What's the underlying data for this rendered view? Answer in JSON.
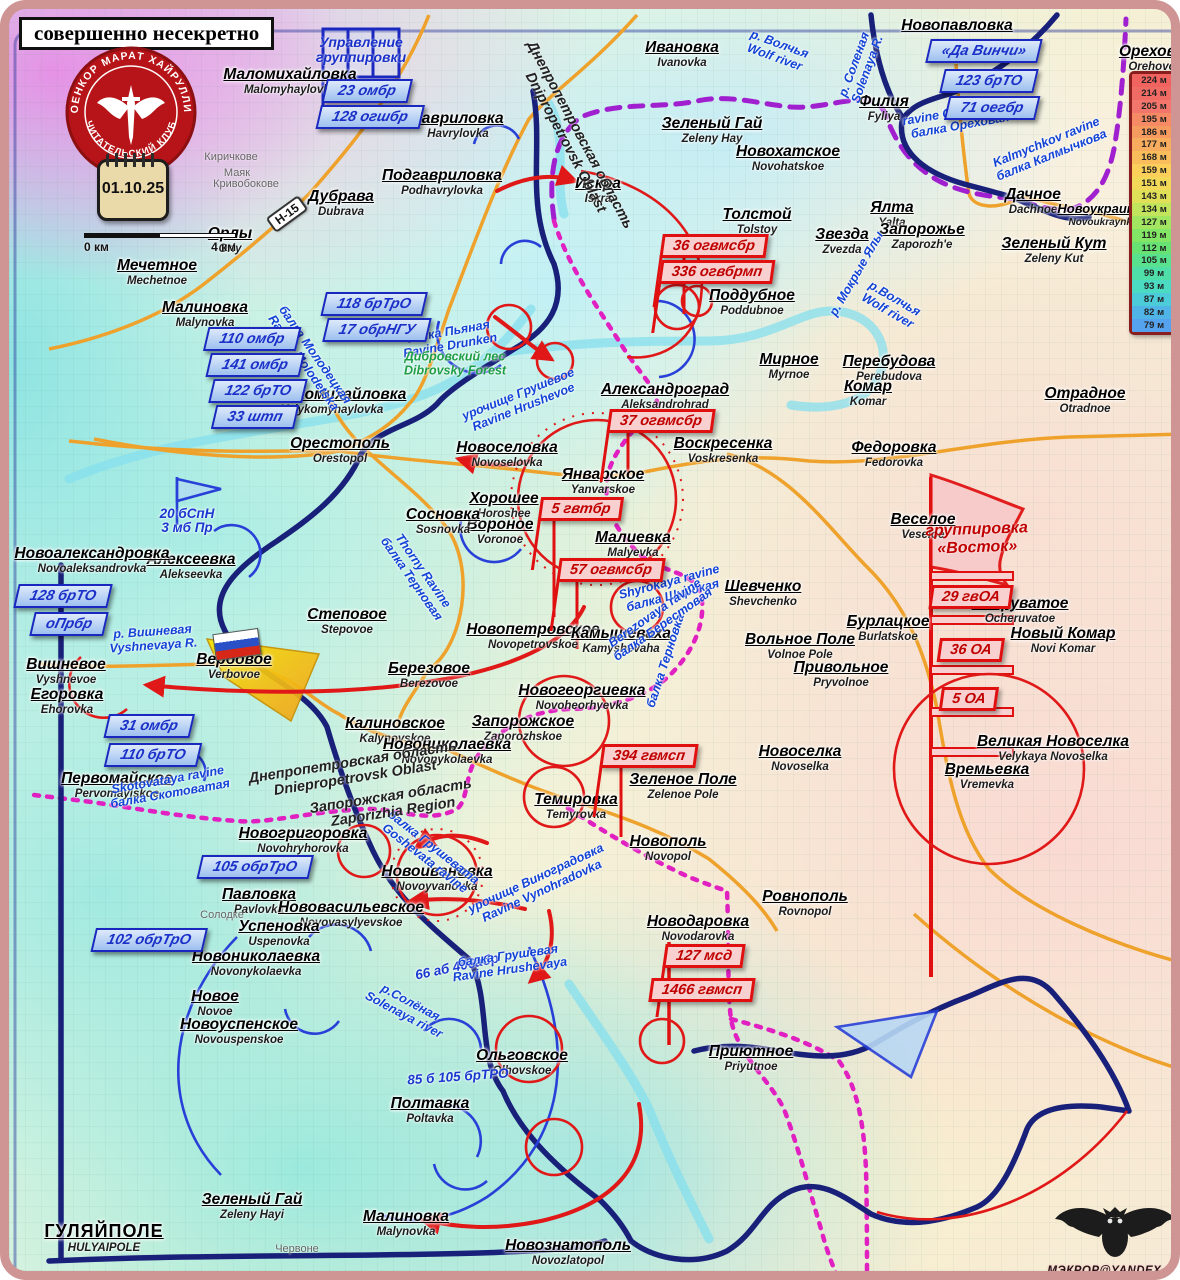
{
  "header": {
    "classification": "совершенно несекретно"
  },
  "logo": {
    "ring_top": "ВОЕНКОР МАРАТ ХАЙРУЛЛИН",
    "ring_bottom": "ЧИТАТЕЛЬСКИЙ КЛУБ"
  },
  "calendar": {
    "date": "01.10.25"
  },
  "scalebar": {
    "start": "0 км",
    "end": "4 км"
  },
  "road_badge": "Н-15",
  "hq_flag": {
    "line1": "Управление",
    "line2": "группировки"
  },
  "grouping_flag": {
    "line1": "группировка",
    "line2": "«Восток»"
  },
  "watermark": {
    "text": "МЭКРОР@YANDEX.RU"
  },
  "legend": {
    "entries": [
      {
        "label": "224 м",
        "color": "#f0635f"
      },
      {
        "label": "214 м",
        "color": "#f06b64"
      },
      {
        "label": "205 м",
        "color": "#f2766b"
      },
      {
        "label": "195 м",
        "color": "#f58a64"
      },
      {
        "label": "186 м",
        "color": "#f69b60"
      },
      {
        "label": "177 м",
        "color": "#f8ac5e"
      },
      {
        "label": "168 м",
        "color": "#f9bd5c"
      },
      {
        "label": "159 м",
        "color": "#fbcf5a"
      },
      {
        "label": "151 м",
        "color": "#f2d957"
      },
      {
        "label": "143 м",
        "color": "#dfdf58"
      },
      {
        "label": "134 м",
        "color": "#c2e35c"
      },
      {
        "label": "127 м",
        "color": "#a2e560"
      },
      {
        "label": "119 м",
        "color": "#82e566"
      },
      {
        "label": "112 м",
        "color": "#68e273"
      },
      {
        "label": "105 м",
        "color": "#59e18d"
      },
      {
        "label": "99 м",
        "color": "#4fdea8"
      },
      {
        "label": "93 м",
        "color": "#4bdac2"
      },
      {
        "label": "87 м",
        "color": "#4cccd8"
      },
      {
        "label": "82 м",
        "color": "#50b5e6"
      },
      {
        "label": "79 м",
        "color": "#55a3ef"
      }
    ]
  },
  "places": [
    {
      "n": "Маломихайловка",
      "t": "Malomyhaylovka",
      "x": 281,
      "y": 57
    },
    {
      "n": "Гавриловка",
      "t": "Havrylovka",
      "x": 449,
      "y": 101
    },
    {
      "n": "Подгавриловка",
      "t": "Podhavrylovka",
      "x": 433,
      "y": 158
    },
    {
      "n": "Дубрава",
      "t": "Dubrava",
      "x": 332,
      "y": 179
    },
    {
      "n": "Орлы",
      "t": "Orly",
      "x": 221,
      "y": 216
    },
    {
      "n": "Мечетное",
      "t": "Mechetnoe",
      "x": 148,
      "y": 248
    },
    {
      "n": "Малиновка",
      "t": "Malynovka",
      "x": 196,
      "y": 290
    },
    {
      "n": "Великомихайловка",
      "t": "Velykomyhaylovka",
      "x": 323,
      "y": 377
    },
    {
      "n": "Орестополь",
      "t": "Orestopol",
      "x": 331,
      "y": 426
    },
    {
      "n": "Ивановка",
      "t": "Ivanovka",
      "x": 673,
      "y": 30
    },
    {
      "n": "Зеленый Гай",
      "t": "Zeleny Hay",
      "x": 703,
      "y": 106
    },
    {
      "n": "Новохатское",
      "t": "Novohatskoe",
      "x": 779,
      "y": 134
    },
    {
      "n": "Искра",
      "t": "Iskra",
      "x": 589,
      "y": 166
    },
    {
      "n": "Толстой",
      "t": "Tolstoy",
      "x": 748,
      "y": 197
    },
    {
      "n": "Звезда",
      "t": "Zvezda",
      "x": 833,
      "y": 217
    },
    {
      "n": "Ялта",
      "t": "Yalta",
      "x": 883,
      "y": 190
    },
    {
      "n": "Запорожье",
      "t": "Zaporozh'e",
      "x": 913,
      "y": 212
    },
    {
      "n": "Поддубное",
      "t": "Poddubnoe",
      "x": 743,
      "y": 278
    },
    {
      "n": "Филия",
      "t": "Fyliya",
      "x": 875,
      "y": 84
    },
    {
      "n": "Новопавловка",
      "t": "",
      "x": 948,
      "y": 8
    },
    {
      "n": "Дачное",
      "t": "Dachnoe",
      "x": 1024,
      "y": 177
    },
    {
      "n": "Новоукраинка",
      "t": "Novoukraynka",
      "x": 1094,
      "y": 192,
      "s": "s"
    },
    {
      "n": "Зеленый Кут",
      "t": "Zeleny Kut",
      "x": 1045,
      "y": 226
    },
    {
      "n": "Орехово",
      "t": "Orehovo",
      "x": 1143,
      "y": 34
    },
    {
      "n": "Мирное",
      "t": "Myrnoe",
      "x": 780,
      "y": 342
    },
    {
      "n": "Перебудова",
      "t": "Perebudova",
      "x": 880,
      "y": 344
    },
    {
      "n": "Комар",
      "t": "Komar",
      "x": 859,
      "y": 369
    },
    {
      "n": "Федоровка",
      "t": "Fedorovka",
      "x": 885,
      "y": 430
    },
    {
      "n": "Отрадное",
      "t": "Otradnoe",
      "x": 1076,
      "y": 376
    },
    {
      "n": "Александроград",
      "t": "Aleksandrohrad",
      "x": 656,
      "y": 372
    },
    {
      "n": "Воскресенка",
      "t": "Voskresenka",
      "x": 714,
      "y": 426
    },
    {
      "n": "Новоселовка",
      "t": "Novoselovka",
      "x": 498,
      "y": 430
    },
    {
      "n": "Хорошее",
      "t": "Horoshee",
      "x": 495,
      "y": 481
    },
    {
      "n": "Вороное",
      "t": "Voronoe",
      "x": 491,
      "y": 507
    },
    {
      "n": "Сосновка",
      "t": "Sosnovka",
      "x": 434,
      "y": 497
    },
    {
      "n": "Январское",
      "t": "Yanvarskoe",
      "x": 594,
      "y": 457
    },
    {
      "n": "Малиевка",
      "t": "Malyevka",
      "x": 624,
      "y": 520
    },
    {
      "n": "Шевченко",
      "t": "Shevchenko",
      "x": 754,
      "y": 569
    },
    {
      "n": "Веселое",
      "t": "Veseloe",
      "x": 914,
      "y": 502
    },
    {
      "n": "Бурлацкое",
      "t": "Burlatskoe",
      "x": 879,
      "y": 604
    },
    {
      "n": "Очеруватое",
      "t": "Ocheruvatoe",
      "x": 1011,
      "y": 586
    },
    {
      "n": "Новый Комар",
      "t": "Novi Komar",
      "x": 1054,
      "y": 616
    },
    {
      "n": "Вольное Поле",
      "t": "Volnoe Pole",
      "x": 791,
      "y": 622
    },
    {
      "n": "Привольное",
      "t": "Pryvolnoe",
      "x": 832,
      "y": 650
    },
    {
      "n": "Новоселка",
      "t": "Novoselka",
      "x": 791,
      "y": 734
    },
    {
      "n": "Великая Новоселка",
      "t": "Velykaya Novoselka",
      "x": 1044,
      "y": 724
    },
    {
      "n": "Времьевка",
      "t": "Vremevka",
      "x": 978,
      "y": 752
    },
    {
      "n": "Зеленое Поле",
      "t": "Zelenoe Pole",
      "x": 674,
      "y": 762
    },
    {
      "n": "Новополь",
      "t": "Novopol",
      "x": 659,
      "y": 824
    },
    {
      "n": "Ровнополь",
      "t": "Rovnopol",
      "x": 796,
      "y": 879
    },
    {
      "n": "Новодаровка",
      "t": "Novodarovka",
      "x": 689,
      "y": 904
    },
    {
      "n": "Приютное",
      "t": "Priyutnoe",
      "x": 742,
      "y": 1034
    },
    {
      "n": "Темировка",
      "t": "Temyrovka",
      "x": 567,
      "y": 782
    },
    {
      "n": "Запорожское",
      "t": "Zaporozhskoe",
      "x": 514,
      "y": 704
    },
    {
      "n": "Новогеоргиевка",
      "t": "Novoheorhyevka",
      "x": 573,
      "y": 673
    },
    {
      "n": "Новопетровское",
      "t": "Novopetrovskoe",
      "x": 524,
      "y": 612
    },
    {
      "n": "Камышеваха",
      "t": "Kamyshevaha",
      "x": 612,
      "y": 616
    },
    {
      "n": "Степовое",
      "t": "Stepovoe",
      "x": 338,
      "y": 597
    },
    {
      "n": "Березовое",
      "t": "Berezovoe",
      "x": 420,
      "y": 651
    },
    {
      "n": "Калиновское",
      "t": "Kalynovskoe",
      "x": 386,
      "y": 706
    },
    {
      "n": "Новониколаевка",
      "t": "Novonykolaevka",
      "x": 438,
      "y": 727
    },
    {
      "n": "Вербовое",
      "t": "Verbovoe",
      "x": 225,
      "y": 642
    },
    {
      "n": "Вишневое",
      "t": "Vyshnevoe",
      "x": 57,
      "y": 647
    },
    {
      "n": "Егоровка",
      "t": "Ehorovka",
      "x": 58,
      "y": 677
    },
    {
      "n": "Алексеевка",
      "t": "Alekseevka",
      "x": 182,
      "y": 542
    },
    {
      "n": "Новоалександровка",
      "t": "Novoaleksandrovka",
      "x": 83,
      "y": 536
    },
    {
      "n": "Первомайское",
      "t": "Pervomayiskoe",
      "x": 108,
      "y": 761
    },
    {
      "n": "Новогригоровка",
      "t": "Novohryhorovka",
      "x": 294,
      "y": 816
    },
    {
      "n": "Новоивановка",
      "t": "Novoyvanovka",
      "x": 428,
      "y": 854
    },
    {
      "n": "Павловка",
      "t": "Pavlovka",
      "x": 250,
      "y": 877
    },
    {
      "n": "Нововасильевское",
      "t": "Novovasylyevskoe",
      "x": 342,
      "y": 890
    },
    {
      "n": "Успеновка",
      "t": "Uspenovka",
      "x": 270,
      "y": 909
    },
    {
      "n": "Новониколаевка",
      "t": "Novonykolaevka",
      "x": 247,
      "y": 939
    },
    {
      "n": "Новое",
      "t": "Novoe",
      "x": 206,
      "y": 979
    },
    {
      "n": "Новоуспенское",
      "t": "Novouspenskoe",
      "x": 230,
      "y": 1007
    },
    {
      "n": "Ольговское",
      "t": "Olhovskoe",
      "x": 513,
      "y": 1038
    },
    {
      "n": "Полтавка",
      "t": "Poltavka",
      "x": 421,
      "y": 1086
    },
    {
      "n": "Зеленый Гай",
      "t": "Zeleny Hayi",
      "x": 243,
      "y": 1182
    },
    {
      "n": "Малиновка",
      "t": "Malynovka",
      "x": 397,
      "y": 1199
    },
    {
      "n": "Новознатополь",
      "t": "Novozlatopol",
      "x": 559,
      "y": 1228
    },
    {
      "n": "ГУЛЯЙПОЛЕ",
      "t": "HULYAIPOLE",
      "x": 95,
      "y": 1212,
      "s": "caps"
    }
  ],
  "tiny_labels": [
    {
      "n": "Киричкове",
      "x": 222,
      "y": 142
    },
    {
      "n": "Маяк",
      "x": 228,
      "y": 158
    },
    {
      "n": "Кривобокове",
      "x": 237,
      "y": 169
    },
    {
      "n": "Солодке",
      "x": 213,
      "y": 900
    },
    {
      "n": "Червоне",
      "x": 288,
      "y": 1234
    }
  ],
  "blue_units": [
    {
      "l": "23 омбр",
      "x": 358,
      "y": 82
    },
    {
      "l": "128 огшбр",
      "x": 361,
      "y": 108
    },
    {
      "l": "118 брТрО",
      "x": 365,
      "y": 295
    },
    {
      "l": "17 обрНГУ",
      "x": 368,
      "y": 321
    },
    {
      "l": "110 омбр",
      "x": 243,
      "y": 330
    },
    {
      "l": "141 омбр",
      "x": 246,
      "y": 356
    },
    {
      "l": "122 брТО",
      "x": 249,
      "y": 382
    },
    {
      "l": "33 штп",
      "x": 246,
      "y": 408
    },
    {
      "l": "128 брТО",
      "x": 54,
      "y": 587
    },
    {
      "l": "оПрбр",
      "x": 60,
      "y": 615
    },
    {
      "l": "31 омбр",
      "x": 140,
      "y": 717
    },
    {
      "l": "110 брТО",
      "x": 144,
      "y": 746
    },
    {
      "l": "105 обрТрО",
      "x": 246,
      "y": 858
    },
    {
      "l": "102 обрТрО",
      "x": 140,
      "y": 931
    },
    {
      "l": "«Да Винчи»",
      "x": 975,
      "y": 42
    },
    {
      "l": "123 брТО",
      "x": 980,
      "y": 72
    },
    {
      "l": "71 оегбр",
      "x": 983,
      "y": 99
    }
  ],
  "red_units": [
    {
      "l": "36 огвмсбр",
      "x": 705,
      "y": 237,
      "f": 1
    },
    {
      "l": "336 огвбрмп",
      "x": 708,
      "y": 263,
      "f": 1
    },
    {
      "l": "37 огвмсбр",
      "x": 652,
      "y": 412,
      "f": 1
    },
    {
      "l": "5 гвтбр",
      "x": 572,
      "y": 500,
      "f": 1
    },
    {
      "l": "57 огвмсбр",
      "x": 602,
      "y": 561,
      "f": 1
    },
    {
      "l": "394 гвмсп",
      "x": 640,
      "y": 747,
      "f": 1
    },
    {
      "l": "29 гвОА",
      "x": 962,
      "y": 588
    },
    {
      "l": "36 ОА",
      "x": 962,
      "y": 641
    },
    {
      "l": "5 ОА",
      "x": 960,
      "y": 690
    },
    {
      "l": "127 мсд",
      "x": 695,
      "y": 947,
      "f": 1
    },
    {
      "l": "1466 гвмсп",
      "x": 693,
      "y": 981
    }
  ],
  "blue_texts": [
    {
      "l": [
        "20 бСпН",
        "3 мб Пр"
      ],
      "x": 178,
      "y": 512,
      "r": 0
    },
    {
      "l": [
        "66 аб 406абр"
      ],
      "x": 448,
      "y": 958,
      "r": -12
    },
    {
      "l": [
        "85 б 105 брТРО"
      ],
      "x": 449,
      "y": 1068,
      "r": -4
    }
  ],
  "water_labels": [
    {
      "l1": "р. Волчья",
      "l2": "Wolf river",
      "x": 768,
      "y": 42,
      "r": 20
    },
    {
      "l1": "ravine Orekhovaya",
      "l2": "балка Ореховая",
      "x": 950,
      "y": 110,
      "r": -10
    },
    {
      "l1": "Kalmychkov ravine",
      "l2": "балка Калмычкова",
      "x": 1040,
      "y": 140,
      "r": -22
    },
    {
      "l1": "р. Мокрые Ялы",
      "l2": "",
      "x": 848,
      "y": 265,
      "r": -60
    },
    {
      "l1": "р. Соленая",
      "l2": "Solenaya R.",
      "x": 852,
      "y": 58,
      "r": -70
    },
    {
      "l1": "балка Пьяная",
      "l2": "Ravine Drunken",
      "x": 440,
      "y": 330,
      "r": -10
    },
    {
      "l1": "Дибровский лес",
      "l2": "Dibrovsky Forest",
      "x": 446,
      "y": 355,
      "r": 0,
      "c": "#1e9e46"
    },
    {
      "l1": "балка Молодецкая",
      "l2": "Ravine Molodetska",
      "x": 300,
      "y": 350,
      "r": 55
    },
    {
      "l1": "р.Волчья",
      "l2": "Wolf river",
      "x": 882,
      "y": 296,
      "r": 30
    },
    {
      "l1": "р. Вишневая",
      "l2": "Vyshnevaya R.",
      "x": 144,
      "y": 630,
      "r": -4
    },
    {
      "l1": "Thorny Ravine",
      "l2": "балка Терновая",
      "x": 408,
      "y": 566,
      "r": 55
    },
    {
      "l1": "балка Терновка",
      "l2": "",
      "x": 657,
      "y": 652,
      "r": -72
    },
    {
      "l1": "Shyrokaya ravine",
      "l2": "балка Широкая",
      "x": 662,
      "y": 580,
      "r": -15
    },
    {
      "l1": "Berezovaya ravine",
      "l2": "балка Берестовая",
      "x": 650,
      "y": 610,
      "r": -35
    },
    {
      "l1": "урочище Грушевое",
      "l2": "Ravine Hrushevoe",
      "x": 512,
      "y": 392,
      "r": -22
    },
    {
      "l1": "Skotovataya ravine",
      "l2": "балка Скотоватая",
      "x": 160,
      "y": 778,
      "r": -10
    },
    {
      "l1": "урочище Виноградовка",
      "l2": "Ravine Vynohradovka",
      "x": 530,
      "y": 876,
      "r": -25
    },
    {
      "l1": "балка Грушевая",
      "l2": "Ravine Hrushevaya",
      "x": 500,
      "y": 954,
      "r": -8
    },
    {
      "l1": "балка Грушевата",
      "l2": "Goshevata ravine",
      "x": 420,
      "y": 844,
      "r": 38
    },
    {
      "l1": "р.Солёная",
      "l2": "Solenaya river",
      "x": 398,
      "y": 1000,
      "r": 28
    }
  ],
  "area_labels": [
    {
      "l1": "Днепропетровская область",
      "l2": "Dnipropetrovsk Oblast",
      "x": 563,
      "y": 130,
      "r": 62
    },
    {
      "l1": "Днепропетровская область",
      "l2": "Dniepropetrovsk Oblast",
      "x": 345,
      "y": 762,
      "r": -9
    },
    {
      "l1": "Запорожская область",
      "l2": "Zaporizhia Region",
      "x": 383,
      "y": 796,
      "r": -9
    }
  ]
}
